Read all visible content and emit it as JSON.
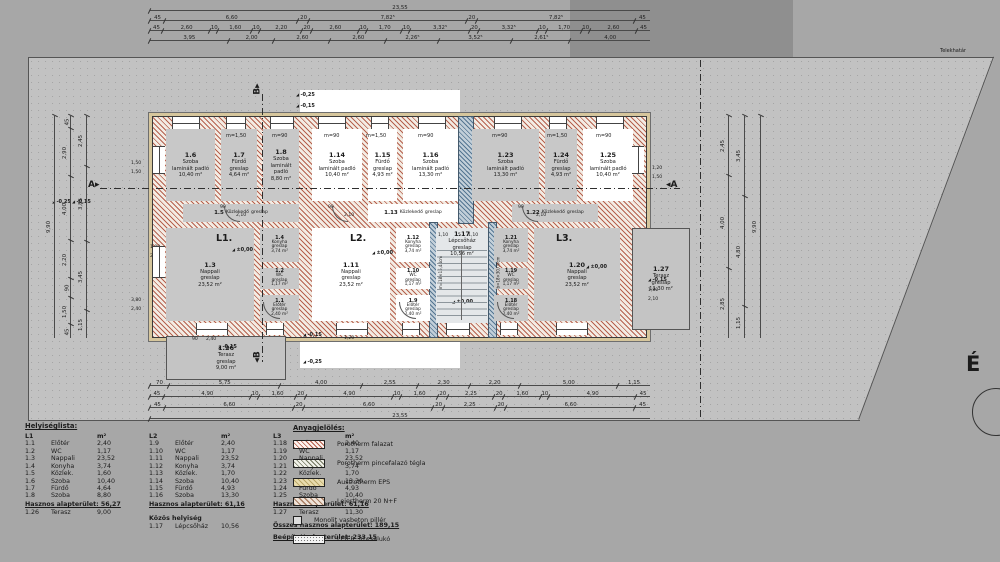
{
  "site": {
    "boundary_label": "Telekhatár",
    "north_label": "É"
  },
  "plan": {
    "apartment_labels": [
      {
        "text": "L1.",
        "x": 216,
        "y": 233
      },
      {
        "text": "L2.",
        "x": 350,
        "y": 233
      },
      {
        "text": "L3.",
        "x": 556,
        "y": 233
      }
    ],
    "section_a": "A",
    "section_b": "B",
    "rooms": [
      {
        "id": "1.6",
        "name": "Szoba",
        "floor": "laminált padló",
        "area": "10,40 m²",
        "x": 166,
        "y": 129,
        "w": 49,
        "h": 72,
        "f": "g"
      },
      {
        "id": "1.7",
        "name": "Fürdő",
        "floor": "greslap",
        "area": "4,64 m²",
        "x": 221,
        "y": 129,
        "w": 36,
        "h": 72,
        "f": "g"
      },
      {
        "id": "1.8",
        "name": "Szoba",
        "floor": "laminált padló",
        "area": "8,80 m²",
        "x": 263,
        "y": 129,
        "w": 36,
        "h": 72,
        "f": "g"
      },
      {
        "id": "1.14",
        "name": "Szoba",
        "floor": "laminált padló",
        "area": "10,40 m²",
        "x": 312,
        "y": 129,
        "w": 50,
        "h": 72,
        "f": "w"
      },
      {
        "id": "1.15",
        "name": "Fürdő",
        "floor": "greslap",
        "area": "4,93 m²",
        "x": 368,
        "y": 129,
        "w": 29,
        "h": 72,
        "f": "w"
      },
      {
        "id": "1.16",
        "name": "Szoba",
        "floor": "laminált padló",
        "area": "13,30 m²",
        "x": 403,
        "y": 129,
        "w": 55,
        "h": 72,
        "f": "w"
      },
      {
        "id": "1.23",
        "name": "Szoba",
        "floor": "laminált padló",
        "area": "13,30 m²",
        "x": 472,
        "y": 129,
        "w": 67,
        "h": 72,
        "f": "g"
      },
      {
        "id": "1.24",
        "name": "Fürdő",
        "floor": "greslap",
        "area": "4,93 m²",
        "x": 545,
        "y": 129,
        "w": 32,
        "h": 72,
        "f": "g"
      },
      {
        "id": "1.25",
        "name": "Szoba",
        "floor": "laminált padló",
        "area": "10,40 m²",
        "x": 583,
        "y": 129,
        "w": 50,
        "h": 72,
        "f": "w"
      },
      {
        "id": "1.5",
        "name": "Közlekedő",
        "floor": "greslap",
        "area": "",
        "x": 183,
        "y": 204,
        "w": 116,
        "h": 18,
        "f": "g",
        "mode": "compact"
      },
      {
        "id": "1.13",
        "name": "Közlekedő",
        "floor": "greslap",
        "area": "",
        "x": 368,
        "y": 204,
        "w": 90,
        "h": 18,
        "f": "w",
        "mode": "compact"
      },
      {
        "id": "1.22",
        "name": "Közlekedő",
        "floor": "greslap",
        "area": "",
        "x": 512,
        "y": 204,
        "w": 86,
        "h": 18,
        "f": "g",
        "mode": "compact"
      },
      {
        "id": "1.3",
        "name": "Nappali",
        "floor": "greslap",
        "area": "23,52 m²",
        "x": 166,
        "y": 228,
        "w": 88,
        "h": 93,
        "f": "g"
      },
      {
        "id": "1.4",
        "name": "Konyha",
        "floor": "greslap",
        "area": "3,74 m²",
        "x": 260,
        "y": 228,
        "w": 39,
        "h": 34,
        "f": "g",
        "mode": "small"
      },
      {
        "id": "1.2",
        "name": "WC",
        "floor": "greslap",
        "area": "1,17 m²",
        "x": 260,
        "y": 268,
        "w": 39,
        "h": 21,
        "f": "g",
        "mode": "small"
      },
      {
        "id": "1.1",
        "name": "Előtér",
        "floor": "greslap",
        "area": "2,40 m²",
        "x": 260,
        "y": 295,
        "w": 39,
        "h": 26,
        "f": "g",
        "mode": "small"
      },
      {
        "id": "1.11",
        "name": "Nappali",
        "floor": "greslap",
        "area": "23,52 m²",
        "x": 312,
        "y": 228,
        "w": 78,
        "h": 93,
        "f": "w"
      },
      {
        "id": "1.12",
        "name": "Konyha",
        "floor": "greslap",
        "area": "3,74 m²",
        "x": 396,
        "y": 228,
        "w": 34,
        "h": 34,
        "f": "w",
        "mode": "small"
      },
      {
        "id": "1.10",
        "name": "WC",
        "floor": "greslap",
        "area": "1,17 m²",
        "x": 396,
        "y": 268,
        "w": 34,
        "h": 21,
        "f": "w",
        "mode": "small"
      },
      {
        "id": "1.9",
        "name": "Előtér",
        "floor": "greslap",
        "area": "2,40 m²",
        "x": 396,
        "y": 295,
        "w": 34,
        "h": 26,
        "f": "w",
        "mode": "small"
      },
      {
        "id": "1.17",
        "name": "Lépcsőház",
        "floor": "greslap",
        "area": "10,56 m²",
        "x": 436,
        "y": 228,
        "w": 52,
        "h": 93,
        "f": "s",
        "mode": "stair"
      },
      {
        "id": "1.21",
        "name": "Konyha",
        "floor": "greslap",
        "area": "3,74 m²",
        "x": 494,
        "y": 228,
        "w": 34,
        "h": 34,
        "f": "g",
        "mode": "small"
      },
      {
        "id": "1.19",
        "name": "WC",
        "floor": "greslap",
        "area": "1,17 m²",
        "x": 494,
        "y": 268,
        "w": 34,
        "h": 21,
        "f": "g",
        "mode": "small"
      },
      {
        "id": "1.18",
        "name": "Előtér",
        "floor": "greslap",
        "area": "2,40 m²",
        "x": 494,
        "y": 295,
        "w": 34,
        "h": 26,
        "f": "g",
        "mode": "small"
      },
      {
        "id": "1.20",
        "name": "Nappali",
        "floor": "greslap",
        "area": "23,52 m²",
        "x": 534,
        "y": 228,
        "w": 86,
        "h": 93,
        "f": "g"
      },
      {
        "id": "1.26",
        "name": "Terasz",
        "floor": "greslap",
        "area": "9,00 m²",
        "x": 166,
        "y": 336,
        "w": 118,
        "h": 42,
        "f": "t"
      },
      {
        "id": "1.27",
        "name": "Terasz",
        "floor": "greslap",
        "area": "11,30 m²",
        "x": 632,
        "y": 228,
        "w": 56,
        "h": 100,
        "f": "t"
      }
    ],
    "window_head_labels": [
      {
        "t": "m=1,50",
        "x": 226,
        "y": 133
      },
      {
        "t": "m=90",
        "x": 272,
        "y": 133
      },
      {
        "t": "m=90",
        "x": 324,
        "y": 133
      },
      {
        "t": "m=1,50",
        "x": 366,
        "y": 133
      },
      {
        "t": "m=90",
        "x": 418,
        "y": 133
      },
      {
        "t": "m=90",
        "x": 492,
        "y": 133
      },
      {
        "t": "m=1,50",
        "x": 547,
        "y": 133
      },
      {
        "t": "m=90",
        "x": 596,
        "y": 133
      }
    ],
    "level_markers": [
      {
        "t": "±0,00",
        "x": 232,
        "y": 247
      },
      {
        "t": "±0,00",
        "x": 372,
        "y": 250
      },
      {
        "t": "±0,00",
        "x": 586,
        "y": 264
      },
      {
        "t": "±0,00",
        "x": 452,
        "y": 299
      },
      {
        "t": "-0,15",
        "x": 218,
        "y": 344
      },
      {
        "t": "-0,15",
        "x": 303,
        "y": 332
      },
      {
        "t": "-0,25",
        "x": 303,
        "y": 359
      },
      {
        "t": "-0,15",
        "x": 648,
        "y": 277
      },
      {
        "t": "-0,25",
        "x": 296,
        "y": 92
      },
      {
        "t": "-0,15",
        "x": 296,
        "y": 103
      },
      {
        "t": "-0,25",
        "x": 52,
        "y": 199
      },
      {
        "t": "-0,15",
        "x": 72,
        "y": 199
      }
    ],
    "inner_dims": [
      {
        "t": "90",
        "x": 220,
        "y": 205
      },
      {
        "t": "2,10",
        "x": 236,
        "y": 213
      },
      {
        "t": "90",
        "x": 328,
        "y": 205
      },
      {
        "t": "2,10",
        "x": 344,
        "y": 213
      },
      {
        "t": "90",
        "x": 518,
        "y": 205
      },
      {
        "t": "2,10",
        "x": 536,
        "y": 213
      },
      {
        "t": "1,20",
        "x": 652,
        "y": 166
      },
      {
        "t": "1,50",
        "x": 652,
        "y": 175
      },
      {
        "t": "1,80",
        "x": 648,
        "y": 288
      },
      {
        "t": "2,10",
        "x": 648,
        "y": 297
      },
      {
        "t": "1,50",
        "x": 131,
        "y": 161
      },
      {
        "t": "1,50",
        "x": 131,
        "y": 170
      },
      {
        "t": "3,80",
        "x": 131,
        "y": 298
      },
      {
        "t": "2,40",
        "x": 131,
        "y": 307
      },
      {
        "t": "1,00",
        "x": 150,
        "y": 245
      },
      {
        "t": "2,40",
        "x": 150,
        "y": 254
      },
      {
        "t": "1,10",
        "x": 438,
        "y": 233
      },
      {
        "t": "5",
        "x": 458,
        "y": 233
      },
      {
        "t": "1,10",
        "x": 468,
        "y": 233
      },
      {
        "t": "1,20",
        "x": 344,
        "y": 336
      },
      {
        "t": "90",
        "x": 192,
        "y": 337
      },
      {
        "t": "2,40",
        "x": 206,
        "y": 337
      }
    ],
    "stair_notes": [
      {
        "t": "m=18×15,44cm",
        "x": 424,
        "y": 270
      },
      {
        "t": "b=18×30,00cm",
        "x": 482,
        "y": 270
      }
    ]
  },
  "dimensions": {
    "top": [
      [
        "23,55"
      ],
      [
        "45",
        "6,60",
        "20",
        "7,82⁵",
        "20",
        "7,82⁵",
        "45"
      ],
      [
        "45",
        "2,60",
        "10",
        "1,60",
        "10",
        "2,20",
        "20",
        "2,60",
        "10",
        "1,70",
        "10",
        "3,32⁵",
        "20",
        "3,32⁵",
        "10",
        "1,70",
        "10",
        "2,60",
        "45"
      ],
      [
        "3,95",
        "2,00",
        "2,60",
        "2,60",
        "2,26⁵",
        "3,52⁵",
        "2,61⁵",
        "4,00"
      ]
    ],
    "bottom": [
      [
        "70",
        "5,75",
        "4,00",
        "2,55",
        "2,30",
        "2,20",
        "5,00",
        "1,15"
      ],
      [
        "45",
        "4,90",
        "10",
        "1,60",
        "20",
        "4,90",
        "10",
        "1,60",
        "20",
        "2,25",
        "20",
        "1,60",
        "10",
        "4,90",
        "45"
      ],
      [
        "45",
        "6,60",
        "20",
        "6,60",
        "20",
        "2,25",
        "20",
        "6,60",
        "45"
      ],
      [
        "23,55"
      ]
    ],
    "left": [
      [
        "9,90"
      ],
      [
        "45",
        "2,90",
        "4,00",
        "2,20",
        "90",
        "1,50",
        "45"
      ],
      [
        "2,45",
        "3,85",
        "3,45",
        "1,15"
      ]
    ],
    "right": [
      [
        "2,45",
        "4,00",
        "2,85"
      ],
      [
        "3,45",
        "4,80",
        "1,15"
      ],
      [
        "9,90"
      ]
    ]
  },
  "room_list": {
    "title": "Helyiséglista:",
    "unit": "m²",
    "groups": [
      {
        "header": "L1",
        "rows": [
          [
            "1.1",
            "Előtér",
            "2,40"
          ],
          [
            "1.2",
            "WC",
            "1,17"
          ],
          [
            "1.3",
            "Nappali",
            "23,52"
          ],
          [
            "1.4",
            "Konyha",
            "3,74"
          ],
          [
            "1.5",
            "Közlek.",
            "1,60"
          ],
          [
            "1.6",
            "Szoba",
            "10,40"
          ],
          [
            "1.7",
            "Fürdő",
            "4,64"
          ],
          [
            "1.8",
            "Szoba",
            "8,80"
          ]
        ],
        "footer": "Hasznos alapterület: 56,27",
        "extra_rows": [
          [
            "1.26",
            "Terasz",
            "9,00"
          ]
        ],
        "extra_title": "",
        "totals": []
      },
      {
        "header": "L2",
        "rows": [
          [
            "1.9",
            "Előtér",
            "2,40"
          ],
          [
            "1.10",
            "WC",
            "1,17"
          ],
          [
            "1.11",
            "Nappali",
            "23,52"
          ],
          [
            "1.12",
            "Konyha",
            "3,74"
          ],
          [
            "1.13",
            "Közlek.",
            "1,70"
          ],
          [
            "1.14",
            "Szoba",
            "10,40"
          ],
          [
            "1.15",
            "Fürdő",
            "4,93"
          ],
          [
            "1.16",
            "Szoba",
            "13,30"
          ]
        ],
        "footer": "Hasznos alapterület: 61,16",
        "extra_title": "Közös helyiség",
        "extra_rows": [
          [
            "1.17",
            "Lépcsőház",
            "10,56"
          ]
        ],
        "totals": []
      },
      {
        "header": "L3",
        "rows": [
          [
            "1.18",
            "Előtér",
            "2,40"
          ],
          [
            "1.19",
            "WC",
            "1,17"
          ],
          [
            "1.20",
            "Nappali",
            "23,52"
          ],
          [
            "1.21",
            "Konyha",
            "3,74"
          ],
          [
            "1.22",
            "Közlek.",
            "1,70"
          ],
          [
            "1.23",
            "Szoba",
            "13,30"
          ],
          [
            "1.24",
            "Fürdő",
            "4,93"
          ],
          [
            "1.25",
            "Szoba",
            "10,40"
          ]
        ],
        "footer": "Hasznos alapterület: 61,16",
        "extra_title": "",
        "extra_rows": [
          [
            "1.27",
            "Terasz",
            "11,30"
          ]
        ],
        "totals": [
          "Összes hasznos alapterület: 189,15",
          "Beépített alapterület: 233,15"
        ]
      }
    ]
  },
  "legend": {
    "title": "Anyagjelölés:",
    "items": [
      {
        "label": "Porotherm falazat",
        "swatch": "porotherm"
      },
      {
        "label": "Porotherm pincefalazó tégla",
        "swatch": "pince"
      },
      {
        "label": "Austrotherm EPS",
        "swatch": "eps"
      },
      {
        "label": "Leiertherm 20 N+F",
        "swatch": "leiertherm"
      },
      {
        "label": "Monolit vasbeton pillér",
        "swatch": "pillar"
      },
      {
        "label": "LEIER 30 zsalukó",
        "swatch": "zsaluko"
      }
    ]
  },
  "colors": {
    "background": "#a7a7a7",
    "site_fill": "#c2c2c2",
    "room_gray": "#c8c8c8",
    "highlight_white": "#ffffff",
    "wall_hatch": "#ab4934",
    "insulation": "#d6c69c",
    "stair_wall_blue": "#3a6080"
  }
}
